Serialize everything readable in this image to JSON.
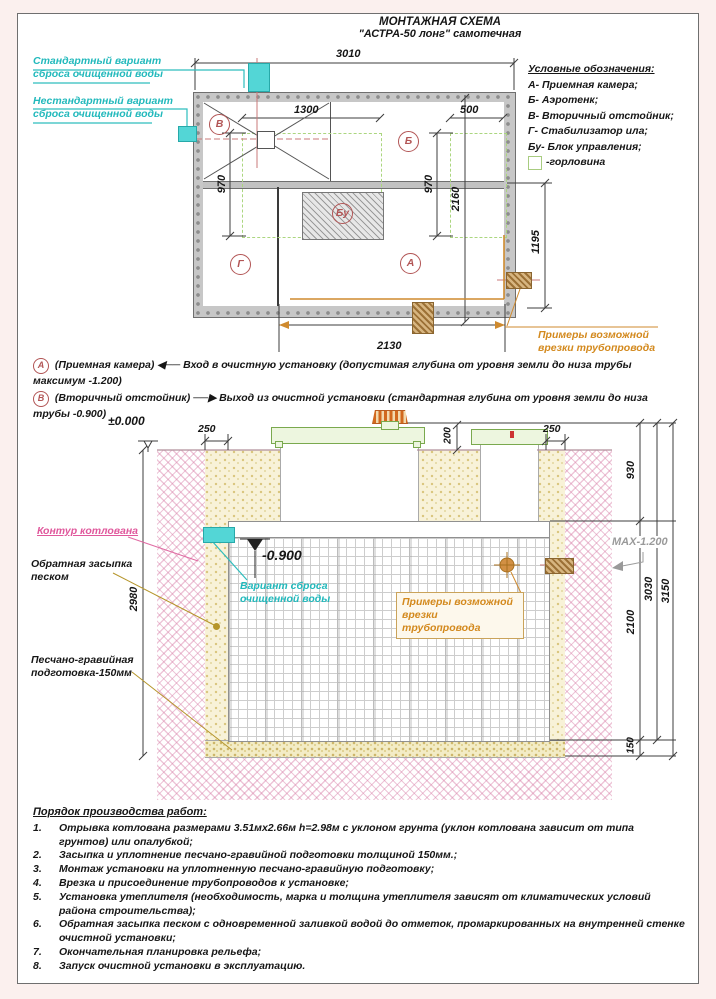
{
  "palette": {
    "teal": "#22b9bc",
    "orange": "#d3891d",
    "pink": "#e0589c",
    "green": "#7aa94e",
    "dark_red": "#b25555",
    "gray": "#9a9a9a"
  },
  "title": {
    "line1": "МОНТАЖНАЯ СХЕМА",
    "line2": "\"АСТРА-50 лонг\" самотечная"
  },
  "legend": {
    "title": "Условные обозначения:",
    "items": [
      "А- Приемная камера;",
      "Б- Аэротенк;",
      "В- Вторичный отстойник;",
      "Г- Стабилизатор ила;",
      "Бу- Блок управления;"
    ],
    "neck_label": "-горловина"
  },
  "plan": {
    "outlet_standard": "Стандартный вариант\nсброса очищенной воды",
    "outlet_nonstandard": "Нестандартный вариант\nсброса очищенной воды",
    "chambers": {
      "v": "В",
      "ae": "Б",
      "g": "Г",
      "a": "А",
      "bu": "Бу"
    },
    "dims": {
      "total_width": "3010",
      "neck1_width": "1300",
      "neck2_width": "500",
      "neck1_depth": "970",
      "neck2_depth": "970",
      "unit_width": "2160",
      "outlet_offset": "1195",
      "inlet_offset": "2130"
    },
    "pipe_note": "Примеры возможной\nврезки трубопровода"
  },
  "notes": {
    "a": {
      "badge": "А",
      "name": "(Приемная камера)",
      "arrow": "◀──",
      "text": "Вход в очистную установку (допустимая глубина от уровня земли до низа трубы максимум -1.200)"
    },
    "b": {
      "badge": "В",
      "name": "(Вторичный отстойник)",
      "arrow": "──▶",
      "text": "Выход из очистной установки (стандартная глубина от уровня земли до низа трубы -0.900)"
    }
  },
  "section": {
    "levels": {
      "zero": "±0.000",
      "outlet": "-0.900",
      "max": "МАХ-1.200"
    },
    "dims": {
      "gap_left": "250",
      "cover_height": "200",
      "gap_right": "250",
      "neck_buried": "930",
      "body_height": "2100",
      "unit_total": "3030",
      "pit_depth": "3150",
      "base_thickness": "150",
      "excavation_depth": "2980"
    },
    "labels": {
      "pit_contour": "Контур котлована",
      "backfill": "Обратная засыпка\nпеском",
      "base": "Песчано-гравийная\nподготовка-150мм",
      "outlet_variant": "Вариант сброса\nочищенной воды",
      "pipe_note": "Примеры возможной\nврезки трубопровода"
    }
  },
  "procedures": {
    "title": "Порядок производства работ:",
    "items": [
      {
        "num": "1.",
        "text": "Отрывка котлована размерами 3.51мх2.66м h=2.98м с уклоном грунта (уклон котлована зависит от типа грунтов) или опалубкой;"
      },
      {
        "num": "2.",
        "text": "Засыпка и уплотнение песчано-гравийной подготовки толщиной 150мм.;"
      },
      {
        "num": "3.",
        "text": "Монтаж установки на уплотненную песчано-гравийную подготовку;"
      },
      {
        "num": "4.",
        "text": "Врезка и присоединение трубопроводов к установке;"
      },
      {
        "num": "5.",
        "text": "Установка утеплителя (необходимость, марка и толщина утеплителя зависят от климатических условий района строительства);"
      },
      {
        "num": "6.",
        "text": "Обратная засыпка песком с одновременной заливкой водой до отметок, промаркированных на внутренней стенке очистной установки;"
      },
      {
        "num": "7.",
        "text": "Окончательная планировка рельефа;"
      },
      {
        "num": "8.",
        "text": "Запуск очистной установки в эксплуатацию."
      }
    ]
  }
}
